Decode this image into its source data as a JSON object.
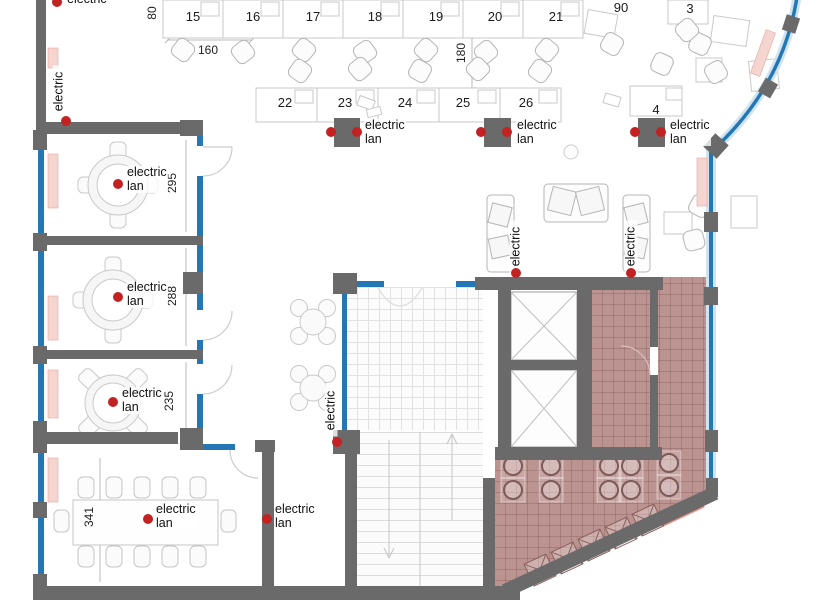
{
  "labels": {
    "electric": "electric",
    "lan": "lan"
  },
  "desks": {
    "row1": [
      "15",
      "16",
      "17",
      "18",
      "19",
      "20",
      "21"
    ],
    "row2": [
      "22",
      "23",
      "24",
      "25",
      "26"
    ],
    "n90": "90",
    "n3": "3",
    "n4": "4"
  },
  "dimensions": {
    "d80": "80",
    "d160": "160",
    "d180": "180",
    "d295": "295",
    "d288": "288",
    "d235": "235",
    "d341": "341"
  },
  "colors": {
    "wall": "#6a6a6a",
    "glass": "#2377b5",
    "glass_halo": "#cfe3f0",
    "cafe_fill": "#bb9390",
    "radiator": "#f5d5d0",
    "radiator_accent": "#e8827a",
    "outlet_dot": "#c32222",
    "furniture_stroke": "#bdbdbd"
  }
}
